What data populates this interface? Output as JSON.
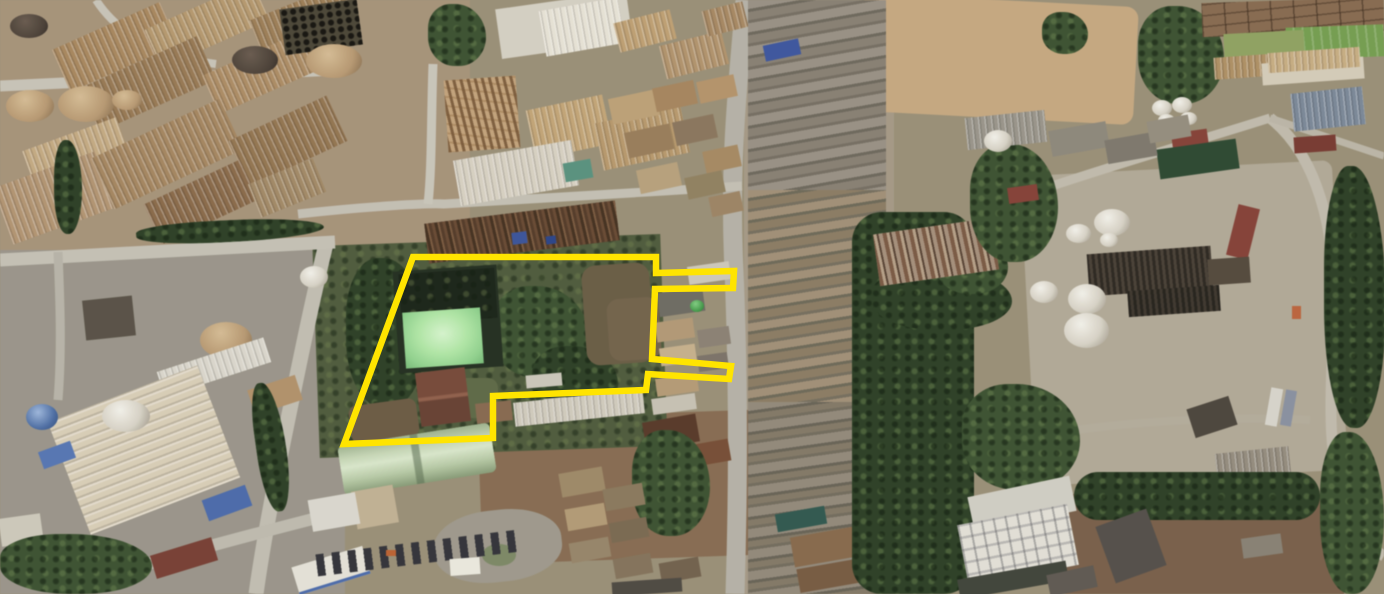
{
  "scene": {
    "type": "satellite-aerial-photo",
    "view": "oblique aerial imagery of an industrial district: warehouses, storage tanks, roads, tree belts and a cleared lot",
    "visible_text": "none",
    "palette": {
      "annotation_yellow": "#ffe400",
      "vegetation_dark": "#3c5330",
      "pond_green": "#aee8a2",
      "dirt_tan": "#c9a97e",
      "road_gray": "#c3bfb2",
      "roof_tan": "#ab885c",
      "tank_white": "#edebe3"
    }
  },
  "annotation": {
    "label": "parcel-boundary",
    "shape": "polygon",
    "stroke_color": "#ffe400",
    "stroke_width": 6.5,
    "fill": "none",
    "points": "413,257 656,257 656,273 734,271 733,288 655,289 652,359 731,366 729,379 648,374 646,390 493,396 493,438 344,444"
  },
  "landmarks": [
    {
      "name": "highlighted-parcel",
      "description": "vacant vegetated parcel outlined in yellow"
    },
    {
      "name": "pond",
      "description": "bright green rectangular pond inside the parcel"
    },
    {
      "name": "parcel-shed",
      "description": "brown gabled building inside the parcel"
    },
    {
      "name": "main-road",
      "description": "north-south road along the east side of the parcel"
    },
    {
      "name": "refinery",
      "description": "chemical plant with white storage tanks, east side"
    },
    {
      "name": "tank-farm",
      "description": "storage tanks and ribbed warehouses, north-west"
    },
    {
      "name": "cleared-dirt-lot",
      "description": "large tan cleared lot, north-east"
    },
    {
      "name": "tree-belt",
      "description": "dense tree belt east of the main road"
    },
    {
      "name": "warehouse-district",
      "description": "large cream warehouse, south-west"
    },
    {
      "name": "green-quonset-warehouse",
      "description": "pale green curved-roof warehouse below the parcel"
    }
  ]
}
